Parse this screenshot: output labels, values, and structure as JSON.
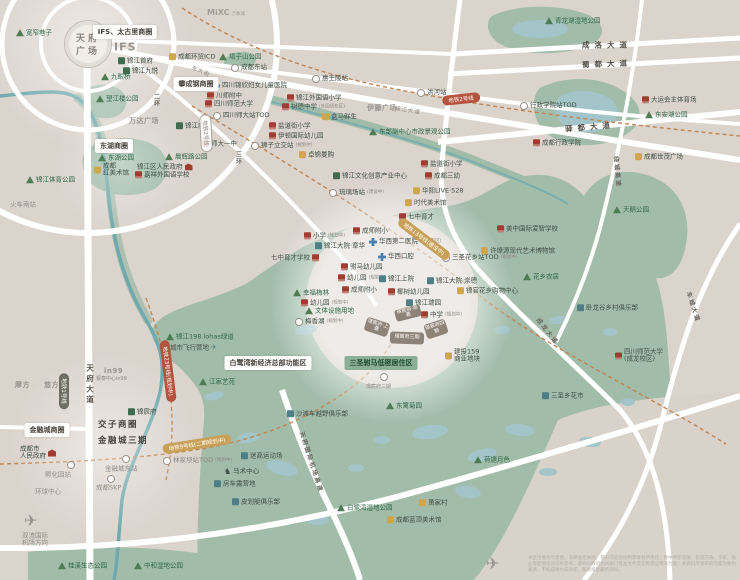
{
  "map": {
    "landmark": {
      "l1": "天府",
      "l2": "广场"
    },
    "logos": {
      "ifs": "IFS",
      "mixc": "MiXC",
      "mixc_sub": "万象城"
    },
    "palette": {
      "background": "#dbd4cd",
      "green_area": "#a2bcaa",
      "water": "#a3c4c8",
      "road": "#ffffff",
      "metro_dashed": "#c08552",
      "badge_gold": "#c9a057",
      "badge_red": "#b4543e",
      "project_block": "#8e8378",
      "school_icon": "#a13c30",
      "hospital_icon": "#4a7fae"
    },
    "badges": [
      {
        "t": "IFS、太古里商圈",
        "x": 125,
        "y": 32,
        "k": "white"
      },
      {
        "t": "攀成钢商圈",
        "x": 196,
        "y": 84,
        "k": "white"
      },
      {
        "t": "东湖商圈",
        "x": 114,
        "y": 146,
        "k": "white"
      },
      {
        "t": "金融城商圈",
        "x": 47,
        "y": 430,
        "k": "white"
      },
      {
        "t": "白鹭湾新经济总部功能区",
        "x": 268,
        "y": 363,
        "k": "white"
      },
      {
        "t": "三圣驸马低密居住区",
        "x": 381,
        "y": 363,
        "k": "green"
      },
      {
        "t": "地铁2号线",
        "x": 461,
        "y": 99,
        "k": "red",
        "r": -6
      },
      {
        "t": "地铁23号线(规划中)",
        "x": 168,
        "y": 371,
        "k": "red",
        "r": 83
      },
      {
        "t": "地铁13号线(建设中)",
        "x": 424,
        "y": 239,
        "k": "gold",
        "r": 37
      },
      {
        "t": "地铁9号线(二期规划中)",
        "x": 197,
        "y": 444,
        "k": "gold",
        "r": -9
      },
      {
        "t": "地铁1号线",
        "x": 64,
        "y": 391,
        "k": "dark",
        "r": 90
      },
      {
        "t": "地铁2号线",
        "x": 206,
        "y": 133,
        "k": "outline",
        "r": 87
      }
    ],
    "road_labels": [
      {
        "t": "成洛大道",
        "x": 607,
        "y": 45,
        "c": "sp"
      },
      {
        "t": "蜀都大道",
        "x": 607,
        "y": 64,
        "c": "sp",
        "r": -2
      },
      {
        "t": "驿都大道",
        "x": 590,
        "y": 127,
        "c": "sp",
        "r": -5
      },
      {
        "t": "东大街",
        "x": 201,
        "y": 71,
        "c": "sm",
        "r": 22
      },
      {
        "t": "锦江大道",
        "x": 408,
        "y": 110,
        "c": "sm",
        "r": 9
      },
      {
        "t": "天府大道",
        "x": 90,
        "y": 385,
        "c": "vert"
      },
      {
        "t": "二环",
        "x": 156,
        "y": 100,
        "c": "vert sm2"
      },
      {
        "t": "三环",
        "x": 238,
        "y": 158,
        "c": "vert sm2"
      },
      {
        "t": "绕城高速",
        "x": 618,
        "y": 172,
        "r": 85,
        "c": "onroad"
      },
      {
        "t": "车城大道",
        "x": 694,
        "y": 307,
        "r": 72,
        "c": "onroad"
      },
      {
        "t": "成龙大道",
        "x": 548,
        "y": 331,
        "r": 52,
        "c": "onroad"
      },
      {
        "t": "天府国际机场高速",
        "x": 312,
        "y": 462,
        "r": 72,
        "c": "onroad"
      }
    ],
    "blocks": [
      {
        "t": "璟宸府·观著",
        "x": 408,
        "y": 313,
        "w": 26,
        "h": 12,
        "r": -14
      },
      {
        "t": "璟宸府·上叠",
        "x": 377,
        "y": 327,
        "w": 24,
        "h": 14,
        "r": 18
      },
      {
        "t": "璟宸府三期",
        "x": 407,
        "y": 338,
        "w": 34,
        "h": 12,
        "r": 2
      },
      {
        "t": "璟宸府四期",
        "x": 436,
        "y": 329,
        "w": 22,
        "h": 15,
        "r": -18
      }
    ],
    "pois": [
      {
        "i": "t",
        "t": "宽窄巷子",
        "x": 16,
        "y": 33
      },
      {
        "i": "g",
        "t": "锦江首府",
        "x": 118,
        "y": 61
      },
      {
        "i": "g",
        "t": "锦江九悦",
        "x": 123,
        "y": 71
      },
      {
        "i": "t",
        "t": "九眼桥",
        "x": 101,
        "y": 77
      },
      {
        "i": "m",
        "t": "成都环贸ICD",
        "x": 169,
        "y": 57
      },
      {
        "i": "t",
        "t": "塔子山公园",
        "x": 219,
        "y": 57
      },
      {
        "i": "M",
        "t": "成都东站",
        "x": 231,
        "y": 68
      },
      {
        "i": "h",
        "t": "四川锦欣妇女儿童医院",
        "x": 212,
        "y": 86
      },
      {
        "i": "s",
        "t": "川师附中",
        "x": 207,
        "y": 96
      },
      {
        "i": "s",
        "t": "四川师范大学",
        "x": 205,
        "y": 104
      },
      {
        "i": "M",
        "t": "四川师大站TOD",
        "x": 213,
        "y": 116
      },
      {
        "t": "万达广场",
        "x": 129,
        "y": 121,
        "c": "logo"
      },
      {
        "i": "g",
        "t": "锦江府",
        "x": 176,
        "y": 126
      },
      {
        "i": "t",
        "t": "望江楼公园",
        "x": 96,
        "y": 99
      },
      {
        "i": "t",
        "t": "东湖公园",
        "x": 98,
        "y": 158
      },
      {
        "i": "t",
        "t": "晨辉路公园",
        "x": 165,
        "y": 157
      },
      {
        "i": "m",
        "t": "成都",
        "l2": "红美术馆",
        "x": 94,
        "y": 170
      },
      {
        "i": "G",
        "t": "锦江区人民政府",
        "x": 137,
        "y": 167,
        "r": 1
      },
      {
        "i": "s",
        "t": "嘉祥外国语学校",
        "x": 135,
        "y": 175
      },
      {
        "i": "t",
        "t": "锦江体育公园",
        "x": 26,
        "y": 180
      },
      {
        "t": "火车南站",
        "x": 10,
        "y": 205,
        "c": "gray"
      },
      {
        "i": "s",
        "t": "师大一中",
        "x": 202,
        "y": 144
      },
      {
        "i": "M",
        "t": "狮子立交站",
        "x": 251,
        "y": 146,
        "s": "(规划中)"
      },
      {
        "i": "s",
        "t": "盐道街小学",
        "x": 269,
        "y": 126
      },
      {
        "i": "s",
        "t": "伊顿国际幼儿园",
        "x": 269,
        "y": 136
      },
      {
        "i": "s",
        "t": "树德中学",
        "x": 282,
        "y": 107,
        "s": "(外国语校区)"
      },
      {
        "i": "s",
        "t": "锦江外国语小学",
        "x": 287,
        "y": 98
      },
      {
        "i": "m",
        "t": "盒马鲜生",
        "x": 322,
        "y": 117
      },
      {
        "i": "m",
        "t": "卓锦曼购",
        "x": 299,
        "y": 155
      },
      {
        "i": "M",
        "t": "惠王陵站",
        "x": 312,
        "y": 79
      },
      {
        "i": "M",
        "t": "洪河站",
        "x": 417,
        "y": 93
      },
      {
        "t": "伊藤广场",
        "x": 367,
        "y": 108,
        "c": "logo"
      },
      {
        "i": "t",
        "t": "东部副中心市政景观公园",
        "x": 369,
        "y": 132
      },
      {
        "i": "g",
        "t": "锦江文化创意产业中心",
        "x": 333,
        "y": 176
      },
      {
        "i": "s",
        "t": "盐道街小学",
        "x": 421,
        "y": 164
      },
      {
        "i": "s",
        "t": "成都三幼",
        "x": 425,
        "y": 176
      },
      {
        "i": "m",
        "t": "华熙LIVE·528",
        "x": 413,
        "y": 191
      },
      {
        "i": "m",
        "t": "时代美术馆",
        "x": 405,
        "y": 203
      },
      {
        "i": "s",
        "t": "七中育才",
        "x": 399,
        "y": 217
      },
      {
        "i": "M",
        "t": "琉璃场站",
        "x": 329,
        "y": 193,
        "s": "(建设中)"
      },
      {
        "i": "s",
        "t": "小学",
        "x": 304,
        "y": 236,
        "s": "(规划中)"
      },
      {
        "i": "b",
        "t": "锦江大院·章华",
        "x": 315,
        "y": 246
      },
      {
        "i": "s",
        "t": "成师附小",
        "x": 353,
        "y": 231
      },
      {
        "i": "h",
        "t": "华西第二医院",
        "x": 369,
        "y": 242,
        "s": "(锦江院区)"
      },
      {
        "i": "h",
        "t": "华西口腔",
        "x": 378,
        "y": 257
      },
      {
        "i": "s",
        "t": "七中育才学校",
        "x": 271,
        "y": 258,
        "r": 1
      },
      {
        "i": "s",
        "t": "驸马幼儿园",
        "x": 341,
        "y": 267
      },
      {
        "i": "s",
        "t": "幼儿园",
        "x": 338,
        "y": 278,
        "s": "(规划中)"
      },
      {
        "i": "b",
        "t": "锦江上院",
        "x": 379,
        "y": 279
      },
      {
        "i": "s",
        "t": "成师附小",
        "x": 342,
        "y": 290
      },
      {
        "i": "s",
        "t": "椰树幼儿园",
        "x": 388,
        "y": 292
      },
      {
        "i": "b",
        "t": "锦江大院·崇德",
        "x": 427,
        "y": 281
      },
      {
        "i": "b",
        "t": "锦江瑞园",
        "x": 406,
        "y": 303
      },
      {
        "i": "s",
        "t": "中学",
        "x": 421,
        "y": 315,
        "s": "(规划中)"
      },
      {
        "i": "M",
        "t": "三圣花乡站TOD",
        "x": 442,
        "y": 258,
        "s": "(规划中)"
      },
      {
        "i": "m",
        "t": "许燎源现代艺术博物馆",
        "x": 481,
        "y": 251
      },
      {
        "i": "s",
        "t": "美中国际爱智学校",
        "x": 497,
        "y": 229
      },
      {
        "i": "t",
        "t": "花乡农居",
        "x": 523,
        "y": 277
      },
      {
        "i": "m",
        "t": "锦官花乡购物中心",
        "x": 457,
        "y": 291
      },
      {
        "i": "t",
        "t": "幸福梅林",
        "x": 293,
        "y": 293
      },
      {
        "i": "s",
        "t": "幼儿园",
        "x": 301,
        "y": 303,
        "s": "(规划中)"
      },
      {
        "i": "t",
        "t": "文体设施用地",
        "x": 305,
        "y": 311
      },
      {
        "i": "M",
        "t": "梅香湖",
        "x": 295,
        "y": 322,
        "s": "(规划中)"
      },
      {
        "i": "t",
        "t": "东篱菊园",
        "x": 386,
        "y": 406
      },
      {
        "i": "m",
        "t": "建投159",
        "l2": "商业地块",
        "x": 445,
        "y": 356
      },
      {
        "i": "b",
        "t": "卧龙谷乡村俱乐部",
        "x": 577,
        "y": 308
      },
      {
        "i": "t",
        "t": "天鹅公园",
        "x": 613,
        "y": 210
      },
      {
        "i": "m",
        "t": "成都世茂广场",
        "x": 635,
        "y": 157
      },
      {
        "i": "s",
        "t": "成都行政学院",
        "x": 533,
        "y": 143
      },
      {
        "i": "M",
        "t": "行政学院站TOD",
        "x": 520,
        "y": 106
      },
      {
        "i": "s",
        "t": "大运会主体育场",
        "x": 642,
        "y": 100
      },
      {
        "i": "t",
        "t": "东安湖公园",
        "x": 645,
        "y": 115
      },
      {
        "i": "t",
        "t": "青龙湖湿地公园",
        "x": 545,
        "y": 21
      },
      {
        "i": "s",
        "t": "四川师范大学",
        "l2": "(成龙校区)",
        "x": 615,
        "y": 356
      },
      {
        "i": "b",
        "t": "三圣乡花市",
        "x": 542,
        "y": 396
      },
      {
        "i": "t",
        "t": "荷塘月色",
        "x": 474,
        "y": 460
      },
      {
        "i": "m",
        "t": "萧家村",
        "x": 419,
        "y": 503
      },
      {
        "i": "m",
        "t": "成都蓝顶美术馆",
        "x": 387,
        "y": 520
      },
      {
        "i": "t",
        "t": "白鹭湾湿地公园",
        "x": 337,
        "y": 508
      },
      {
        "i": "b",
        "t": "皮划艇俱乐部",
        "x": 232,
        "y": 502
      },
      {
        "i": "b",
        "t": "房车露营地",
        "x": 214,
        "y": 484
      },
      {
        "i": "H",
        "t": "马术中心",
        "x": 224,
        "y": 472
      },
      {
        "i": "b",
        "t": "迷高运动场",
        "x": 241,
        "y": 456
      },
      {
        "i": "b",
        "t": "沙滩车越野俱乐部",
        "x": 287,
        "y": 414
      },
      {
        "i": "t",
        "t": "江家艺苑",
        "x": 199,
        "y": 382
      },
      {
        "i": "t",
        "t": "锦江198.lohas绿道",
        "x": 166,
        "y": 337
      },
      {
        "i": "P",
        "t": "城市飞行营地",
        "x": 170,
        "y": 348,
        "r": 1,
        "c": "sp"
      },
      {
        "i": "g",
        "t": "锦宸府",
        "x": 128,
        "y": 412
      },
      {
        "t": "交子商圈",
        "x": 98,
        "y": 426,
        "c": "bold"
      },
      {
        "t": "金融城三期",
        "x": 98,
        "y": 442,
        "c": "bold"
      },
      {
        "i": "M",
        "t": "",
        "x": 122,
        "y": 459
      },
      {
        "t": "金融城东站",
        "x": 105,
        "y": 469,
        "c": "gray"
      },
      {
        "i": "M",
        "t": "林家坝站TOD",
        "x": 163,
        "y": 461,
        "s": "(规划中)",
        "c": "metroT"
      },
      {
        "i": "M",
        "t": "",
        "x": 107,
        "y": 479
      },
      {
        "t": "成都SKP",
        "x": 96,
        "y": 488,
        "c": "gray"
      },
      {
        "i": "M",
        "t": "",
        "x": 67,
        "y": 465
      },
      {
        "t": "孵化园站",
        "x": 45,
        "y": 475,
        "c": "gray"
      },
      {
        "t": "环球中心",
        "x": 35,
        "y": 492,
        "c": "gray"
      },
      {
        "i": "G",
        "t": "成都市",
        "l2": "人民政府",
        "x": 20,
        "y": 453,
        "r": 1
      },
      {
        "t": "摩方",
        "x": 15,
        "y": 385,
        "c": "logo"
      },
      {
        "t": "悠方",
        "x": 44,
        "y": 385,
        "c": "logo"
      },
      {
        "t": "in99",
        "x": 104,
        "y": 371,
        "c": "logo"
      },
      {
        "t": "银泰中心in99",
        "x": 96,
        "y": 380,
        "c": "tiny"
      },
      {
        "i": "P",
        "t": "",
        "x": 24,
        "y": 521,
        "c": "bigplane"
      },
      {
        "t": "双流国际",
        "l2": "机场方向",
        "x": 22,
        "y": 540,
        "c": "gray"
      },
      {
        "i": "t",
        "t": "桂溪生态公园",
        "x": 58,
        "y": 566
      },
      {
        "i": "t",
        "t": "中和湿地公园",
        "x": 134,
        "y": 566
      },
      {
        "i": "P",
        "t": "",
        "x": 486,
        "y": 564,
        "c": "bigplane"
      },
      {
        "i": "M",
        "t": "",
        "x": 380,
        "y": 377
      },
      {
        "t": "璟宸府三期",
        "x": 366,
        "y": 388,
        "c": "tiny"
      }
    ],
    "disclaimer": "本区位图为示意图，非精准距离图，部分内容因绘制需要有所简化；图中所示道路、轨道交通、学校、商业等配套信息仅供参考，最终以政府相关部门批准文件及实际建设情况为准；本资料所发布的内容为要约邀请，不构成要约或承诺，敬请留意最新资料。"
  }
}
